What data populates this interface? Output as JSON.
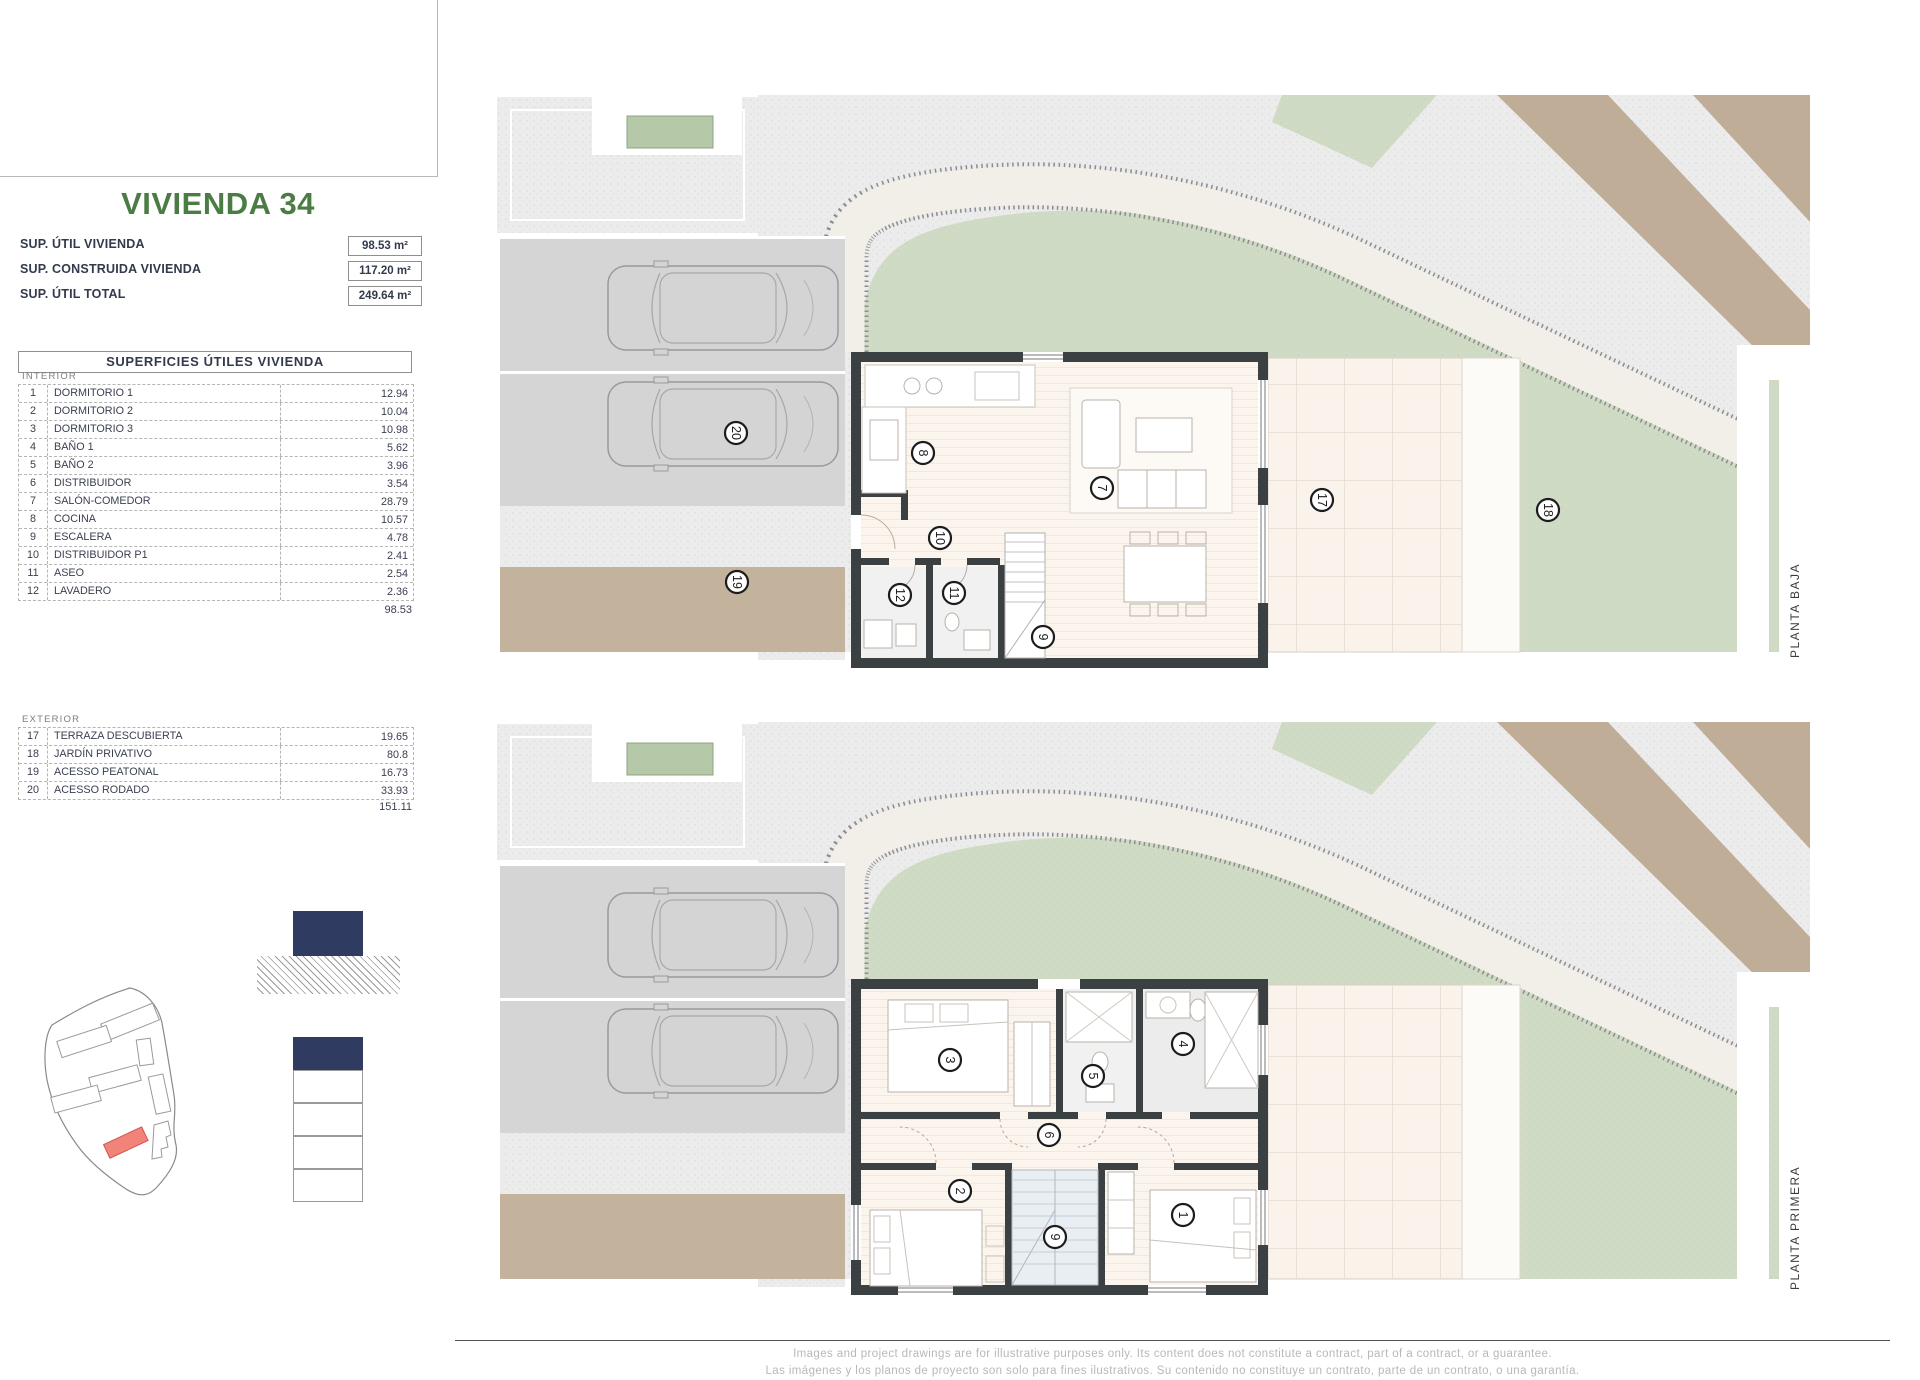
{
  "sidebar": {
    "title": "VIVIENDA 34",
    "summary": [
      {
        "label": "SUP. ÚTIL VIVIENDA",
        "value": "98.53 m²"
      },
      {
        "label": "SUP. CONSTRUIDA VIVIENDA",
        "value": "117.20 m²"
      },
      {
        "label": "SUP. ÚTIL TOTAL",
        "value": "249.64 m²"
      }
    ],
    "table": {
      "header": "SUPERFICIES ÚTILES VIVIENDA",
      "interior_label": "INTERIOR",
      "interior_rows": [
        [
          "1",
          "DORMITORIO 1",
          "12.94"
        ],
        [
          "2",
          "DORMITORIO 2",
          "10.04"
        ],
        [
          "3",
          "DORMITORIO 3",
          "10.98"
        ],
        [
          "4",
          "BAÑO 1",
          "5.62"
        ],
        [
          "5",
          "BAÑO 2",
          "3.96"
        ],
        [
          "6",
          "DISTRIBUIDOR",
          "3.54"
        ],
        [
          "7",
          "SALÓN-COMEDOR",
          "28.79"
        ],
        [
          "8",
          "COCINA",
          "10.57"
        ],
        [
          "9",
          "ESCALERA",
          "4.78"
        ],
        [
          "10",
          "DISTRIBUIDOR P1",
          "2.41"
        ],
        [
          "11",
          "ASEO",
          "2.54"
        ],
        [
          "12",
          "LAVADERO",
          "2.36"
        ]
      ],
      "interior_total": "98.53",
      "exterior_label": "EXTERIOR",
      "exterior_rows": [
        [
          "17",
          "TERRAZA DESCUBIERTA",
          "19.65"
        ],
        [
          "18",
          "JARDÍN PRIVATIVO",
          "80.8"
        ],
        [
          "19",
          "ACESSO PEATONAL",
          "16.73"
        ],
        [
          "20",
          "ACESSO RODADO",
          "33.93"
        ]
      ],
      "exterior_total": "151.11"
    }
  },
  "plans": [
    {
      "key": "pb",
      "label": "PLANTA BAJA",
      "markers": [
        {
          "n": "20",
          "x": 736,
          "y": 433
        },
        {
          "n": "19",
          "x": 737,
          "y": 582
        },
        {
          "n": "8",
          "x": 923,
          "y": 453
        },
        {
          "n": "10",
          "x": 940,
          "y": 538
        },
        {
          "n": "7",
          "x": 1102,
          "y": 488
        },
        {
          "n": "12",
          "x": 900,
          "y": 595
        },
        {
          "n": "11",
          "x": 954,
          "y": 593
        },
        {
          "n": "9",
          "x": 1043,
          "y": 637
        },
        {
          "n": "17",
          "x": 1322,
          "y": 500
        },
        {
          "n": "18",
          "x": 1548,
          "y": 510
        }
      ]
    },
    {
      "key": "pp",
      "label": "PLANTA PRIMERA",
      "markers": [
        {
          "n": "3",
          "x": 950,
          "y": 1060
        },
        {
          "n": "5",
          "x": 1093,
          "y": 1076
        },
        {
          "n": "4",
          "x": 1183,
          "y": 1044
        },
        {
          "n": "6",
          "x": 1049,
          "y": 1135
        },
        {
          "n": "2",
          "x": 960,
          "y": 1191
        },
        {
          "n": "9",
          "x": 1055,
          "y": 1237
        },
        {
          "n": "1",
          "x": 1183,
          "y": 1215
        }
      ]
    }
  ],
  "footer": {
    "line_en": "Images and project drawings are for illustrative purposes only. Its content does not constitute a contract, part of a contract, or a guarantee.",
    "line_es": "Las imágenes y los planos de proyecto son solo para fines ilustrativos. Su contenido no constituye un contrato, parte de un contrato, o una garantía."
  },
  "colors": {
    "title_green": "#4a7c44",
    "navy": "#2f3b60",
    "garden_green": "#cfdbc4",
    "beige_path": "#c3b29c",
    "tan_strip": "#c0ad98",
    "plot_red": "#f2837b",
    "wall_dark": "#3b4043"
  }
}
